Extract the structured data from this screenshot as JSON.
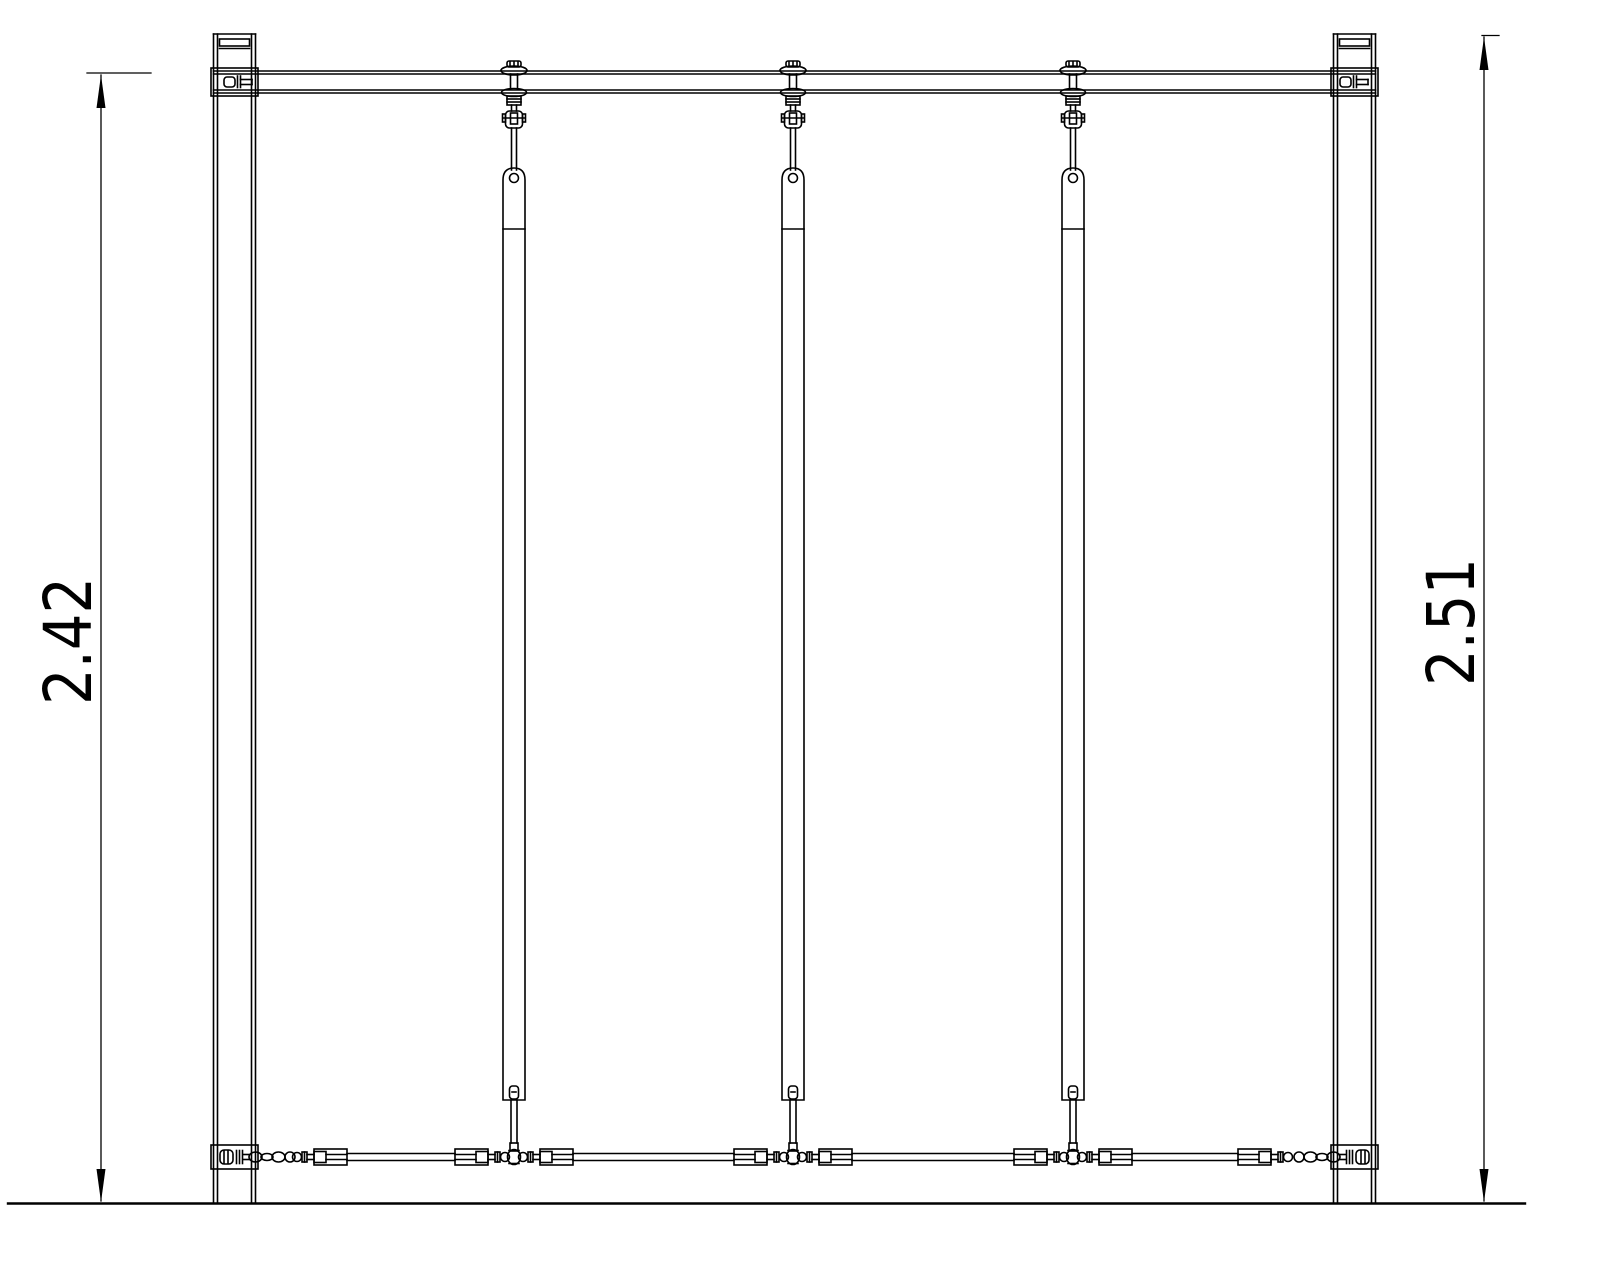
{
  "annotations": {
    "left_dimension": {
      "value": "2.42",
      "orientation": "vertical",
      "measures": "beam-top-to-ground"
    },
    "right_dimension": {
      "value": "2.51",
      "orientation": "vertical",
      "measures": "post-top-to-ground"
    }
  },
  "structure": {
    "posts": 2,
    "top_beams": 1,
    "vertical_hanger_bars": 3,
    "bottom_turnbuckles": 8,
    "anchor_chains": 2,
    "ground_lines": 1
  },
  "colors": {
    "background": "#ffffff",
    "line": "#000000"
  }
}
